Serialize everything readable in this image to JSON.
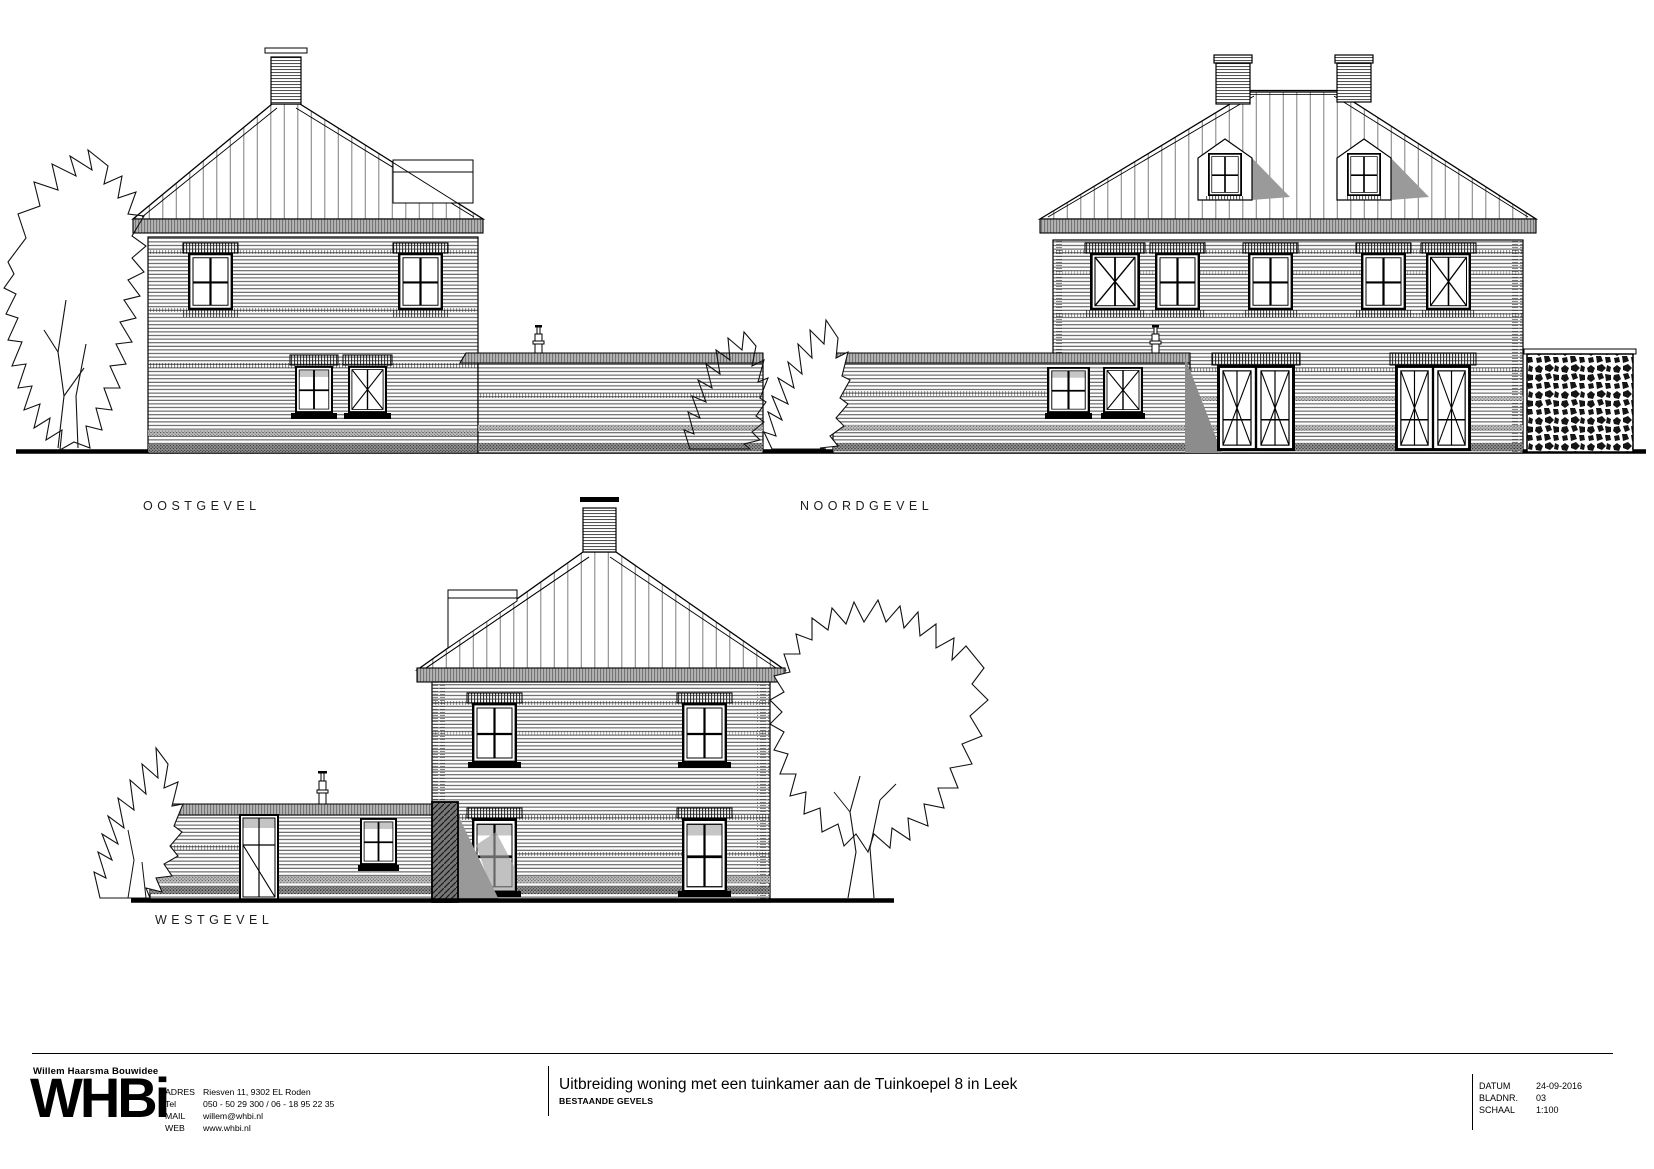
{
  "colors": {
    "paper": "#ffffff",
    "ink": "#000000",
    "siding_line": "#4d4d4d",
    "roof_seam": "#888888",
    "fascia_gray": "#b3b3b3",
    "shadow_gray": "#9a9a9a",
    "dark_shadow": "#6e6e6e"
  },
  "elevations": {
    "east": {
      "label": "OOSTGEVEL"
    },
    "north": {
      "label": "NOORDGEVEL"
    },
    "west": {
      "label": "WESTGEVEL"
    }
  },
  "titleblock": {
    "company_name": "Willem Haarsma Bouwidee",
    "logo_text": "WHBi",
    "contact": [
      {
        "label": "ADRES",
        "value": "Riesven 11, 9302 EL Roden"
      },
      {
        "label": "Tel",
        "value": "050 - 50 29 300 / 06 - 18 95 22 35"
      },
      {
        "label": "MAIL",
        "value": "willem@whbi.nl"
      },
      {
        "label": "WEB",
        "value": "www.whbi.nl"
      }
    ],
    "project_title": "Uitbreiding woning met een tuinkamer aan de Tuinkoepel 8 in Leek",
    "project_subtitle": "BESTAANDE GEVELS",
    "meta": [
      {
        "label": "DATUM",
        "value": "24-09-2016"
      },
      {
        "label": "BLADNR.",
        "value": "03"
      },
      {
        "label": "SCHAAL",
        "value": "1:100"
      }
    ]
  }
}
